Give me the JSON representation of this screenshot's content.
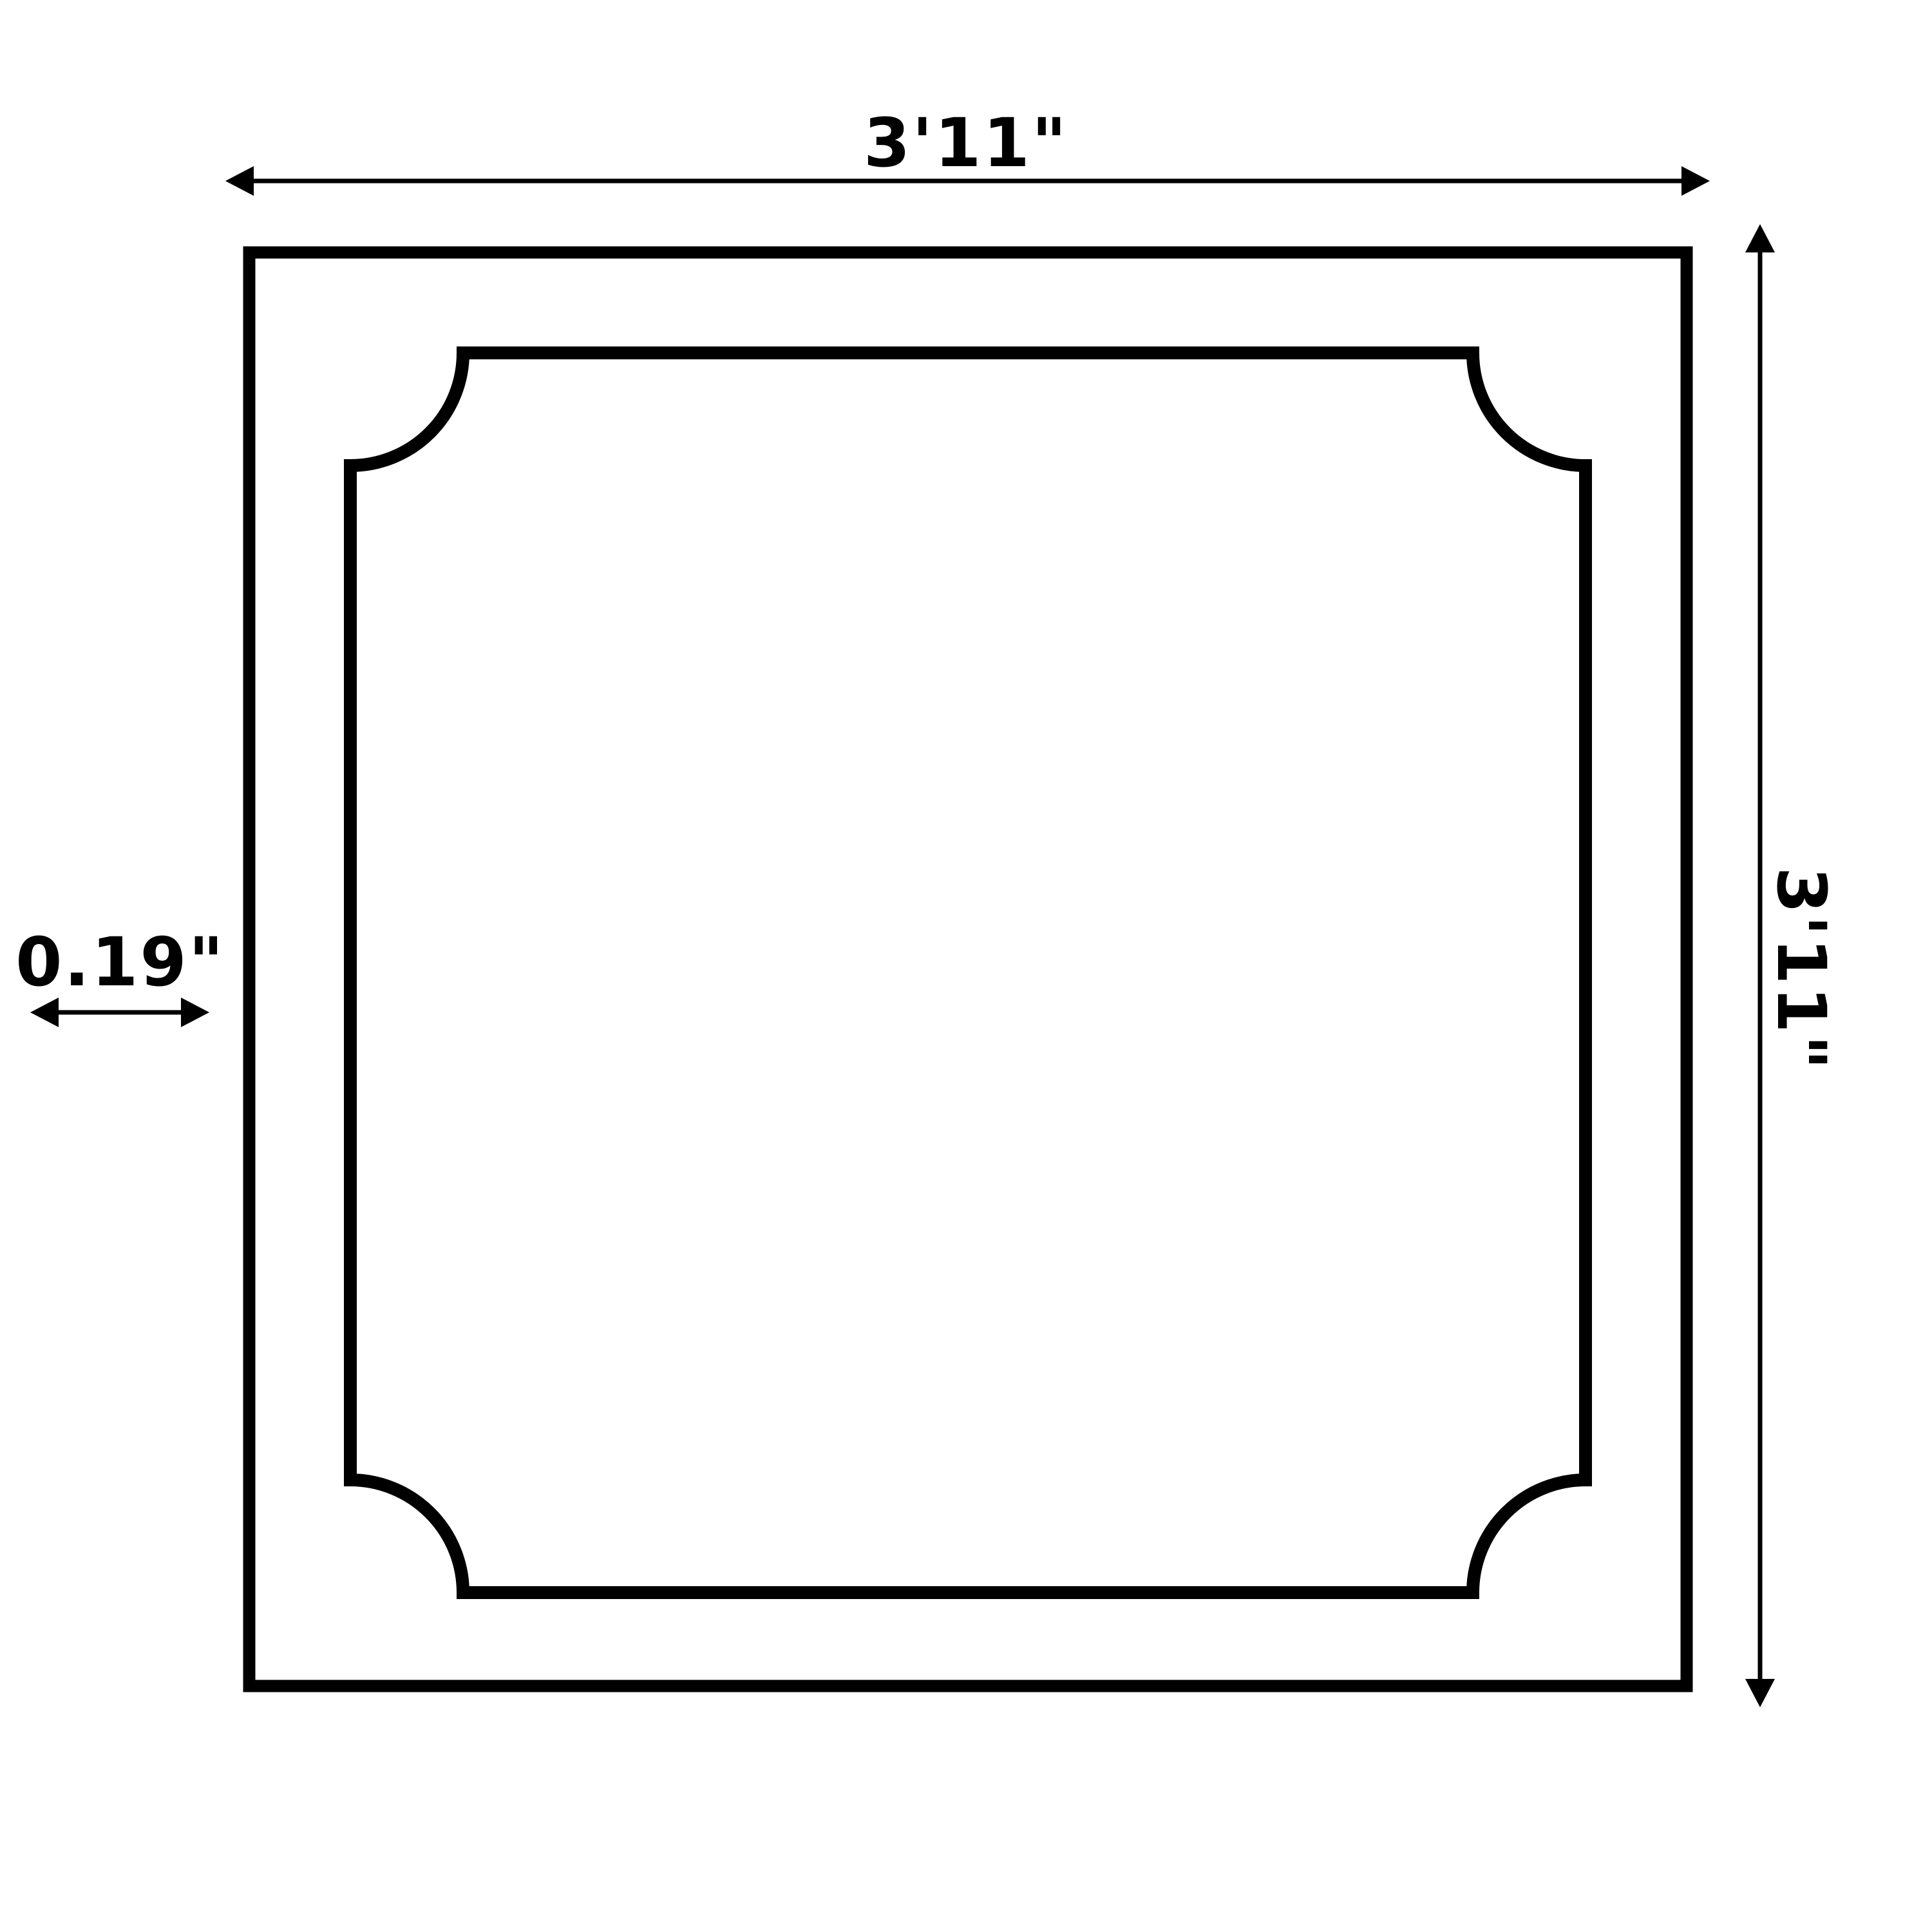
{
  "dimensions": {
    "width_label": "3'11\"",
    "height_label": "3'11\"",
    "thickness_label": "0.19\""
  },
  "colors": {
    "line": "#000000",
    "background": "#ffffff"
  }
}
